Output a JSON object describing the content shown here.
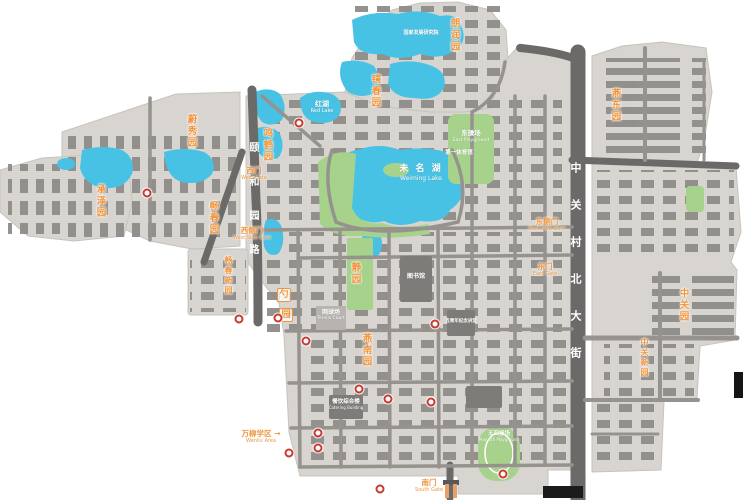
{
  "map": {
    "lakes": {
      "weiming_zh": "未 名 湖",
      "weiming_en": "Weiming Lake",
      "red_zh": "红湖",
      "red_en": "Red Lake"
    },
    "streets": {
      "zhongguancun_north": "中关村北大街",
      "yiheyuan_road": "颐和园路"
    },
    "gardens": {
      "langrunyuan": "朗润园",
      "jingchunyuan": "镜春园",
      "yandongyuan": "燕东园",
      "weixiuyuan": "蔚秀园",
      "mingheyuan": "鸣鹤园",
      "chengzeyuan": "承泽园",
      "changchunyuan": "畅春园",
      "changchunxinyuan": "畅春新园",
      "yannanyuan": "燕南园",
      "zhongguanyuan": "中关园",
      "zhongguanxinyuan": "中关新园",
      "jingyuan": "静园",
      "shaoyuan_char1": "勺",
      "shaoyuan_char2": "园"
    },
    "gates": {
      "west_zh": "西门",
      "west_en": "West Gate",
      "west_side_zh": "西侧门",
      "west_side_en": "West Side Gate",
      "east_side_zh": "东侧门",
      "east_side_en": "East Side Gate",
      "east_zh": "东门",
      "east_en": "East Gate",
      "south_zh": "南门",
      "south_en": "South Gate",
      "southwest_sign_zh": "万柳学区 →",
      "southwest_sign_en": "Wanliu Area"
    },
    "places": {
      "east_playground_zh": "东操场",
      "east_playground_en": "East Playground",
      "may4_zh": "五四操场",
      "may4_en": "May 4th Playground",
      "tennis_zh": "网球场",
      "tennis_en": "Tennis Court",
      "gym1_zh": "第一体育馆",
      "library_zh": "图书馆",
      "centennial_zh": "百周年纪念讲堂",
      "nsd_zh": "国家发展研究院",
      "catering_zh": "餐饮综合楼",
      "catering_en": "Catering Building"
    },
    "colors": {
      "ground": "#d8d5d1",
      "building": "#8f8d8a",
      "road": "#6c6a68",
      "water": "#47c2e5",
      "green": "#a6d28c",
      "label_orange": "#f0953c",
      "marker_red": "#c93a30"
    },
    "markers": [
      [
        299,
        123
      ],
      [
        147,
        193
      ],
      [
        239,
        319
      ],
      [
        278,
        318
      ],
      [
        306,
        341
      ],
      [
        435,
        324
      ],
      [
        359,
        389
      ],
      [
        388,
        399
      ],
      [
        431,
        402
      ],
      [
        318,
        433
      ],
      [
        318,
        448
      ],
      [
        289,
        453
      ],
      [
        503,
        474
      ],
      [
        380,
        489
      ]
    ]
  }
}
